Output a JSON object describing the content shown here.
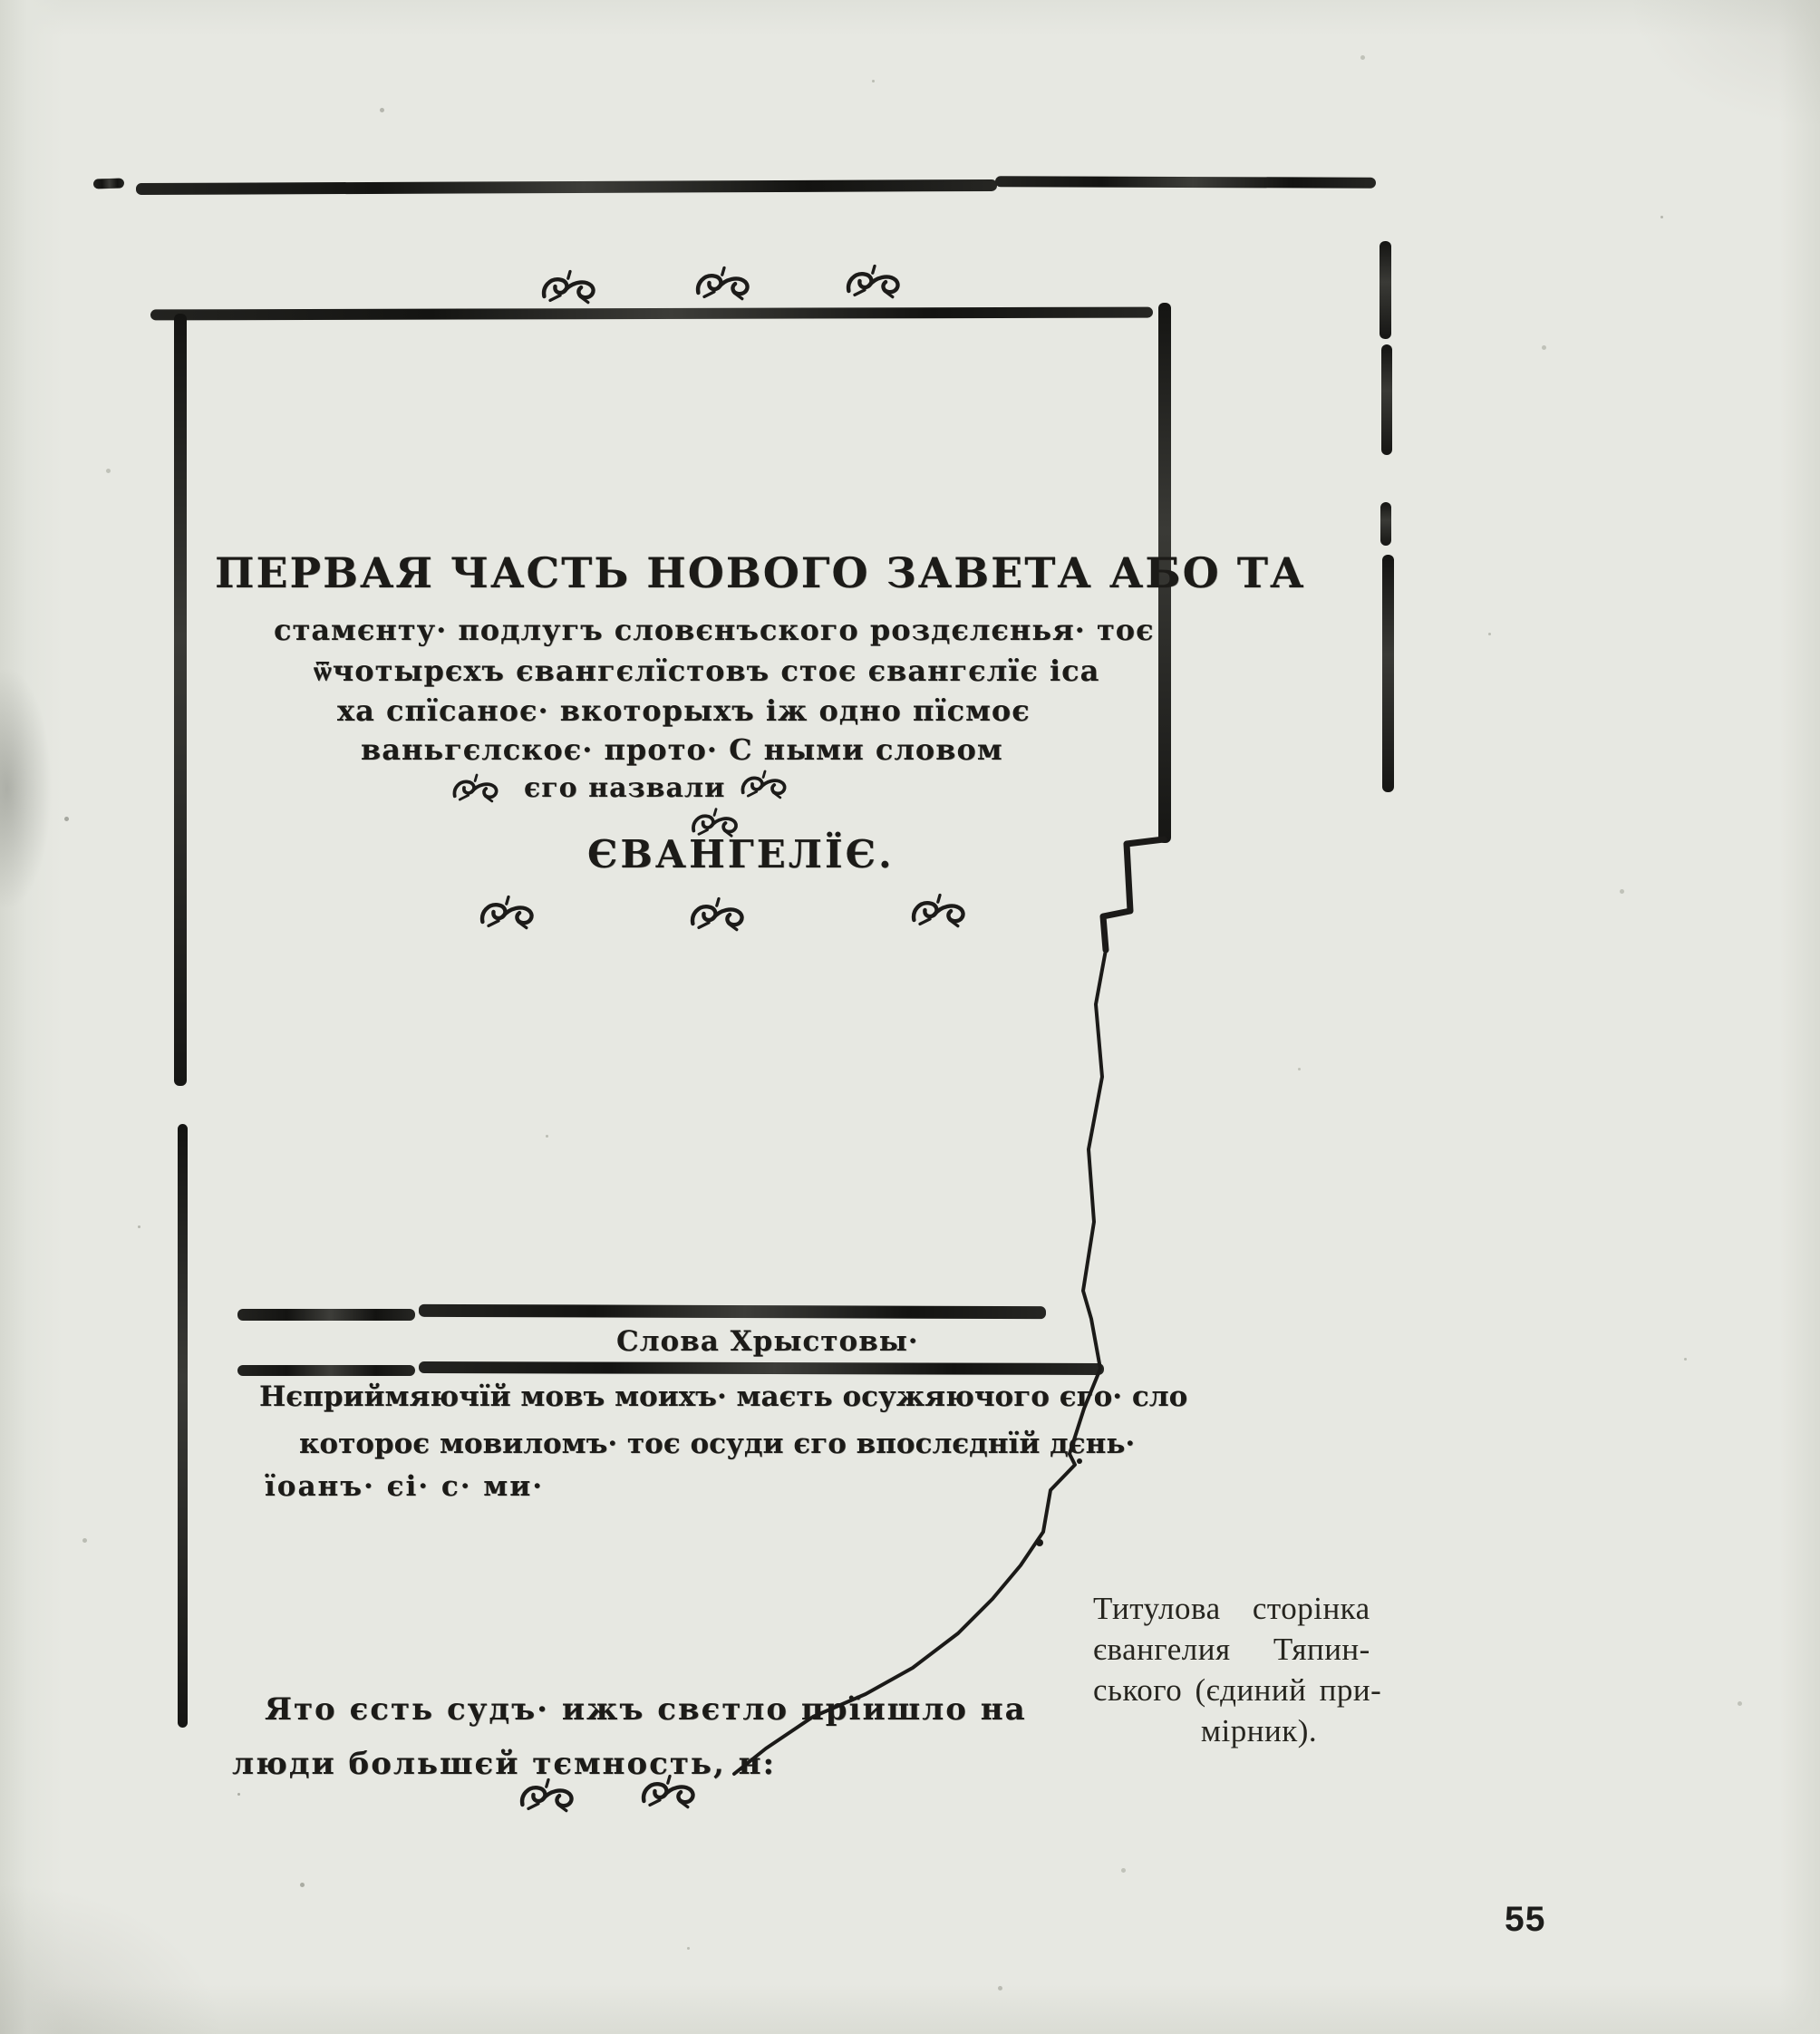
{
  "colors": {
    "paper": "#e7e8e2",
    "facsimile_ink": "#1c1b18",
    "caption_ink": "#26251f"
  },
  "icons": {
    "fleuron": "printer's leaf ornament (hedera ❧)"
  },
  "facsimile": {
    "title_line1": "ПЕРВАЯ ЧАСТЬ НОВОГО ЗАВЕТА АБО ТА",
    "title_line2": "стамєнту· подлугъ словєнъского роздєлєнья· тоє",
    "title_line3": "ѿчотырєхъ євангєлїстовъ стоє євангєлїє іса",
    "title_line4": "ха спїсаноє· вкоторыхъ іж одно пїсмоє",
    "title_line5": "ваньгєлскоє· прото· С ными словом",
    "title_line6": "єго назвали",
    "evangelie": "ЄВАНГЕЛЇЄ.",
    "section_heading": "Слова Хрыстовы·",
    "quote1_line1": "Нєприймяючїй мовъ моихъ· маєть осужяючого єго· сло",
    "quote1_line2": "котороє мовиломъ· тоє осуди єго впослєднїй дєнь·",
    "quote1_line3": "їоанъ· єі· с· ми·",
    "quote2_line1": "Ято єсть судъ· ижъ свєтло прїишло на",
    "quote2_line2": "люди большєй тємность, н:"
  },
  "caption": {
    "line1": "Титулова сторінка",
    "line2": "євангелия Тяпин-",
    "line3": "ського (єдиний при-",
    "line4": "мірник)."
  },
  "page_number": "55"
}
